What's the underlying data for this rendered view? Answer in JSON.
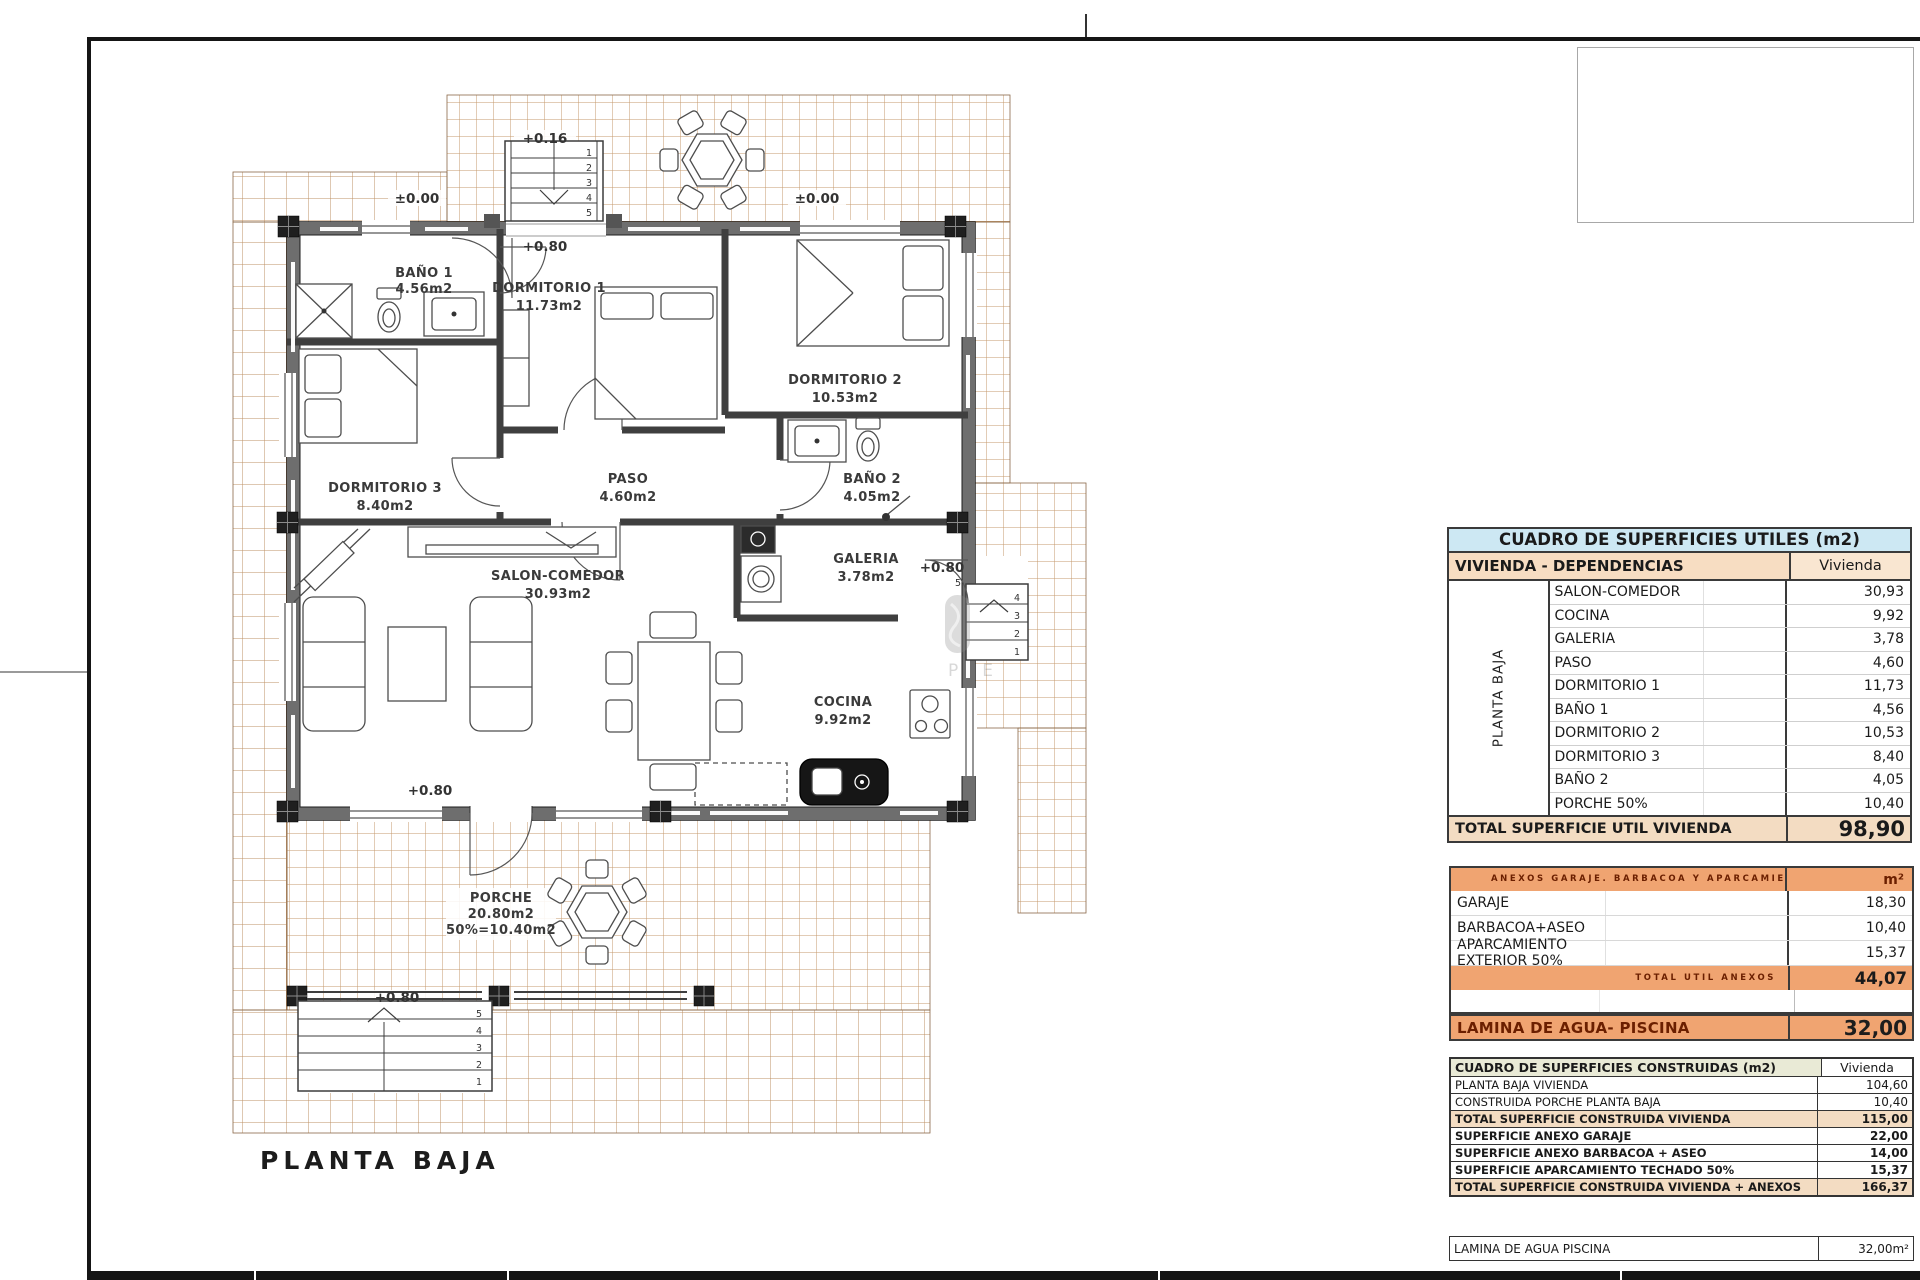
{
  "page": {
    "title": "PLANTA BAJA",
    "watermark": "PE"
  },
  "plan": {
    "rooms": {
      "bano1_name": "BAÑO 1",
      "bano1_area": "4.56m2",
      "dorm1_name": "DORMITORIO 1",
      "dorm1_area": "11.73m2",
      "dorm2_name": "DORMITORIO 2",
      "dorm2_area": "10.53m2",
      "dorm3_name": "DORMITORIO 3",
      "dorm3_area": "8.40m2",
      "paso_name": "PASO",
      "paso_area": "4.60m2",
      "bano2_name": "BAÑO 2",
      "bano2_area": "4.05m2",
      "salon_name": "SALON-COMEDOR",
      "salon_area": "30.93m2",
      "galeria_name": "GALERIA",
      "galeria_area": "3.78m2",
      "cocina_name": "COCINA",
      "cocina_area": "9.92m2",
      "porche_name": "PORCHE",
      "porche_area": "20.80m2",
      "porche_pct": "50%=10.40m2"
    },
    "levels": {
      "upper": "+0.16",
      "ground": "±0.00",
      "main": "+0.80"
    },
    "steps": {
      "s1": "1",
      "s2": "2",
      "s3": "3",
      "s4": "4",
      "s5": "5"
    }
  },
  "tables": {
    "utiles": {
      "title": "CUADRO DE SUPERFICIES UTILES (m2)",
      "subheader": "VIVIENDA - DEPENDENCIAS",
      "col_header": "Vivienda",
      "side_label": "PLANTA BAJA",
      "rows": [
        {
          "label": "SALON-COMEDOR",
          "value": "30,93"
        },
        {
          "label": "COCINA",
          "value": "9,92"
        },
        {
          "label": "GALERIA",
          "value": "3,78"
        },
        {
          "label": "PASO",
          "value": "4,60"
        },
        {
          "label": "DORMITORIO 1",
          "value": "11,73"
        },
        {
          "label": "BAÑO 1",
          "value": "4,56"
        },
        {
          "label": "DORMITORIO 2",
          "value": "10,53"
        },
        {
          "label": "DORMITORIO 3",
          "value": "8,40"
        },
        {
          "label": "BAÑO 2",
          "value": "4,05"
        },
        {
          "label": "PORCHE 50%",
          "value": "10,40"
        }
      ],
      "total_label": "TOTAL SUPERFICIE UTIL VIVIENDA",
      "total_value": "98,90"
    },
    "anexos": {
      "header": "ANEXOS GARAJE. BARBACOA Y APARCAMIENTO",
      "unit": "m²",
      "rows": [
        {
          "label": "GARAJE",
          "value": "18,30"
        },
        {
          "label": "BARBACOA+ASEO",
          "value": "10,40"
        },
        {
          "label": "APARCAMIENTO EXTERIOR 50%",
          "value": "15,37"
        }
      ],
      "total_label": "TOTAL UTIL ANEXOS",
      "total_value": "44,07"
    },
    "piscina_row": {
      "label": "LAMINA DE AGUA- PISCINA",
      "value": "32,00"
    },
    "construidas": {
      "title": "CUADRO DE SUPERFICIES CONSTRUIDAS (m2)",
      "col_header": "Vivienda",
      "rows": [
        {
          "label": "PLANTA BAJA VIVIENDA",
          "value": "104,60"
        },
        {
          "label": "CONSTRUIDA PORCHE PLANTA BAJA",
          "value": "10,40"
        },
        {
          "label": "TOTAL SUPERFICIE CONSTRUIDA VIVIENDA",
          "value": "115,00"
        },
        {
          "label": "SUPERFICIE ANEXO GARAJE",
          "value": "22,00"
        },
        {
          "label": "SUPERFICIE ANEXO BARBACOA + ASEO",
          "value": "14,00"
        },
        {
          "label": "SUPERFICIE APARCAMIENTO TECHADO 50%",
          "value": "15,37"
        },
        {
          "label": "TOTAL SUPERFICIE CONSTRUIDA VIVIENDA + ANEXOS",
          "value": "166,37"
        }
      ]
    },
    "piscina_row2": {
      "label": "LAMINA DE AGUA PISCINA",
      "value": "32,00m²"
    }
  }
}
